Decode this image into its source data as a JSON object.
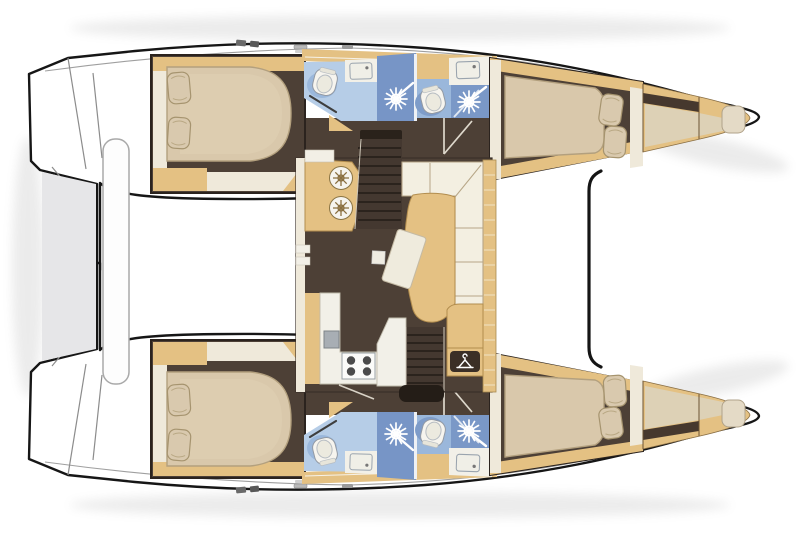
{
  "meta": {
    "description": "Top-down interior layout plan of a four-cabin sailing catamaran",
    "orientation": "bows pointing right, transom platforms at left",
    "visible_text": "none"
  },
  "colors": {
    "hull_white": "#ffffff",
    "outline_black": "#161616",
    "floor_brown": "#4d4036",
    "floor_steps": "#443830",
    "step_line": "#2b231d",
    "teak_tan": "#e4c183",
    "tan_edge": "#b28c4e",
    "bulkhead_cream": "#efe9da",
    "counter_white": "#f2f0e8",
    "mattress": "#d9c8ab",
    "mattress_edge": "#b3a07e",
    "pillow": "#d9c9ae",
    "bath_blue_light": "#b6cde7",
    "bath_blue_mid": "#9ab7db",
    "shower_blue_dark": "#7795c6",
    "fixture_white": "#f6f4ee",
    "appliance_gray": "#a8aeb4",
    "burner_gray": "#4b4b4b",
    "landing_black": "#241d17",
    "hanger_plate": "#3b2f26",
    "stern_shadow_gray": "#e6e6e8",
    "forepeak_cream": "#ddd1b6",
    "forepeak_dark": "#46382e",
    "deck_seam_gray": "#9f9f9f"
  },
  "layout": {
    "hulls": [
      {
        "side": "upper hull",
        "cabins": [
          {
            "name": "aft double cabin",
            "bed": "island double bed",
            "pillows": 2
          },
          {
            "name": "forward double cabin",
            "bed": "double berth",
            "pillows": 2
          },
          {
            "name": "forepeak berth",
            "pillows": 1
          }
        ],
        "bathrooms": [
          {
            "name": "aft bathroom",
            "fixtures": [
              "toilet",
              "washbasin",
              "shower"
            ]
          },
          {
            "name": "forward bathroom",
            "fixtures": [
              "toilet",
              "washbasin",
              "shower"
            ]
          }
        ]
      },
      {
        "side": "lower hull",
        "cabins": [
          {
            "name": "aft double cabin",
            "bed": "island double bed",
            "pillows": 2
          },
          {
            "name": "forward double cabin",
            "bed": "double berth",
            "pillows": 2
          },
          {
            "name": "forepeak berth",
            "pillows": 1
          }
        ],
        "bathrooms": [
          {
            "name": "aft bathroom",
            "fixtures": [
              "toilet",
              "washbasin",
              "shower"
            ]
          },
          {
            "name": "forward bathroom",
            "fixtures": [
              "toilet",
              "washbasin",
              "shower"
            ]
          }
        ]
      }
    ],
    "saloon": {
      "galley": {
        "round_sinks": 2,
        "stove_burners": 4,
        "appliance_unit": 1
      },
      "furniture": [
        "L-shaped sofa",
        "dining table",
        "angled seat",
        "aft bench",
        "wardrobe with hanger icon"
      ],
      "companionway_stairs": 2
    },
    "deck": {
      "bow": "crossbeam / trampoline area between bows",
      "stern": "transom steps and dinghy platform bar",
      "fittings": "small deck hardware on side decks"
    }
  }
}
